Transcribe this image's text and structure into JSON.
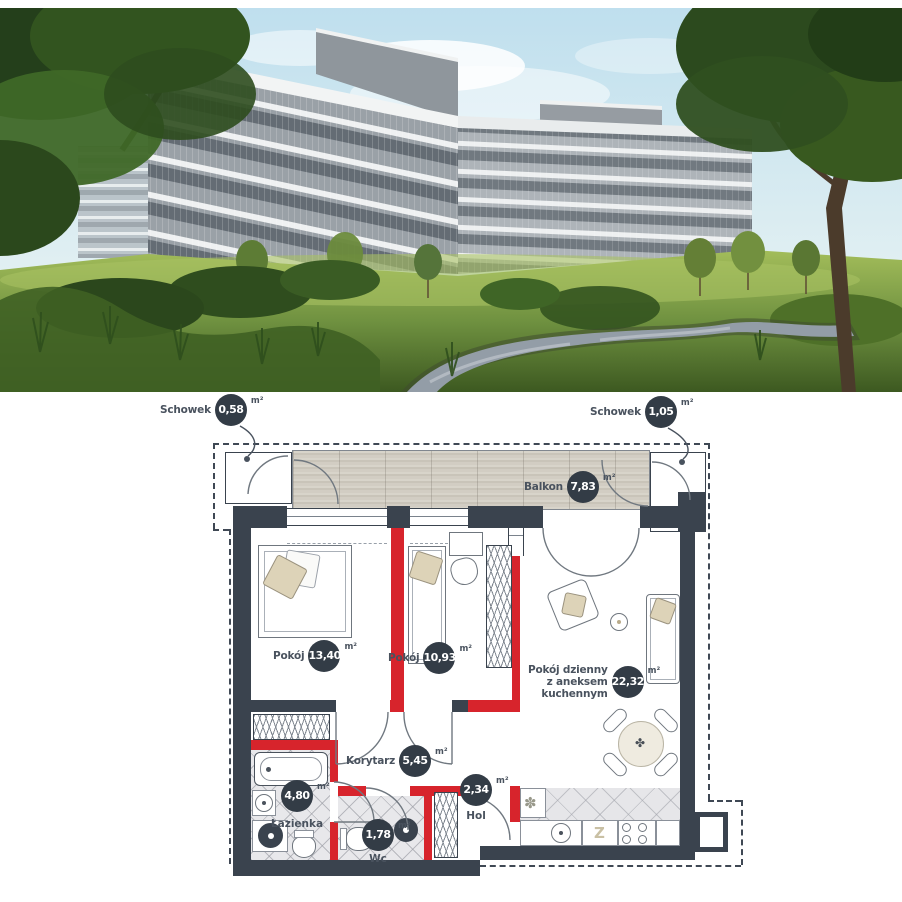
{
  "photo": {
    "sky_color": "#c5e3ef",
    "grass_color": "#6f9140",
    "building_color": "#9aa1a7"
  },
  "floorplan": {
    "unit": "m²",
    "colors": {
      "wall": "#3a434e",
      "red": "#d7242c",
      "badge": "#333c46"
    },
    "storage_left": {
      "label": "Schowek",
      "area": "0,58"
    },
    "storage_right": {
      "label": "Schowek",
      "area": "1,05"
    },
    "balcony": {
      "label": "Balkon",
      "area": "7,83"
    },
    "room1": {
      "label": "Pokój",
      "area": "13,40"
    },
    "room2": {
      "label": "Pokój",
      "area": "10,93"
    },
    "living": {
      "line1": "Pokój dzienny",
      "line2": "z aneksem",
      "line3": "kuchennym",
      "area": "22,32"
    },
    "corridor": {
      "label": "Korytarz",
      "area": "5,45"
    },
    "bathroom": {
      "label": "Łazienka",
      "area": "4,80"
    },
    "wc": {
      "label": "Wc",
      "area": "1,78"
    },
    "hall": {
      "label": "Hol",
      "area": "2,34"
    },
    "kitchen": {
      "dishwasher": "Z"
    }
  }
}
